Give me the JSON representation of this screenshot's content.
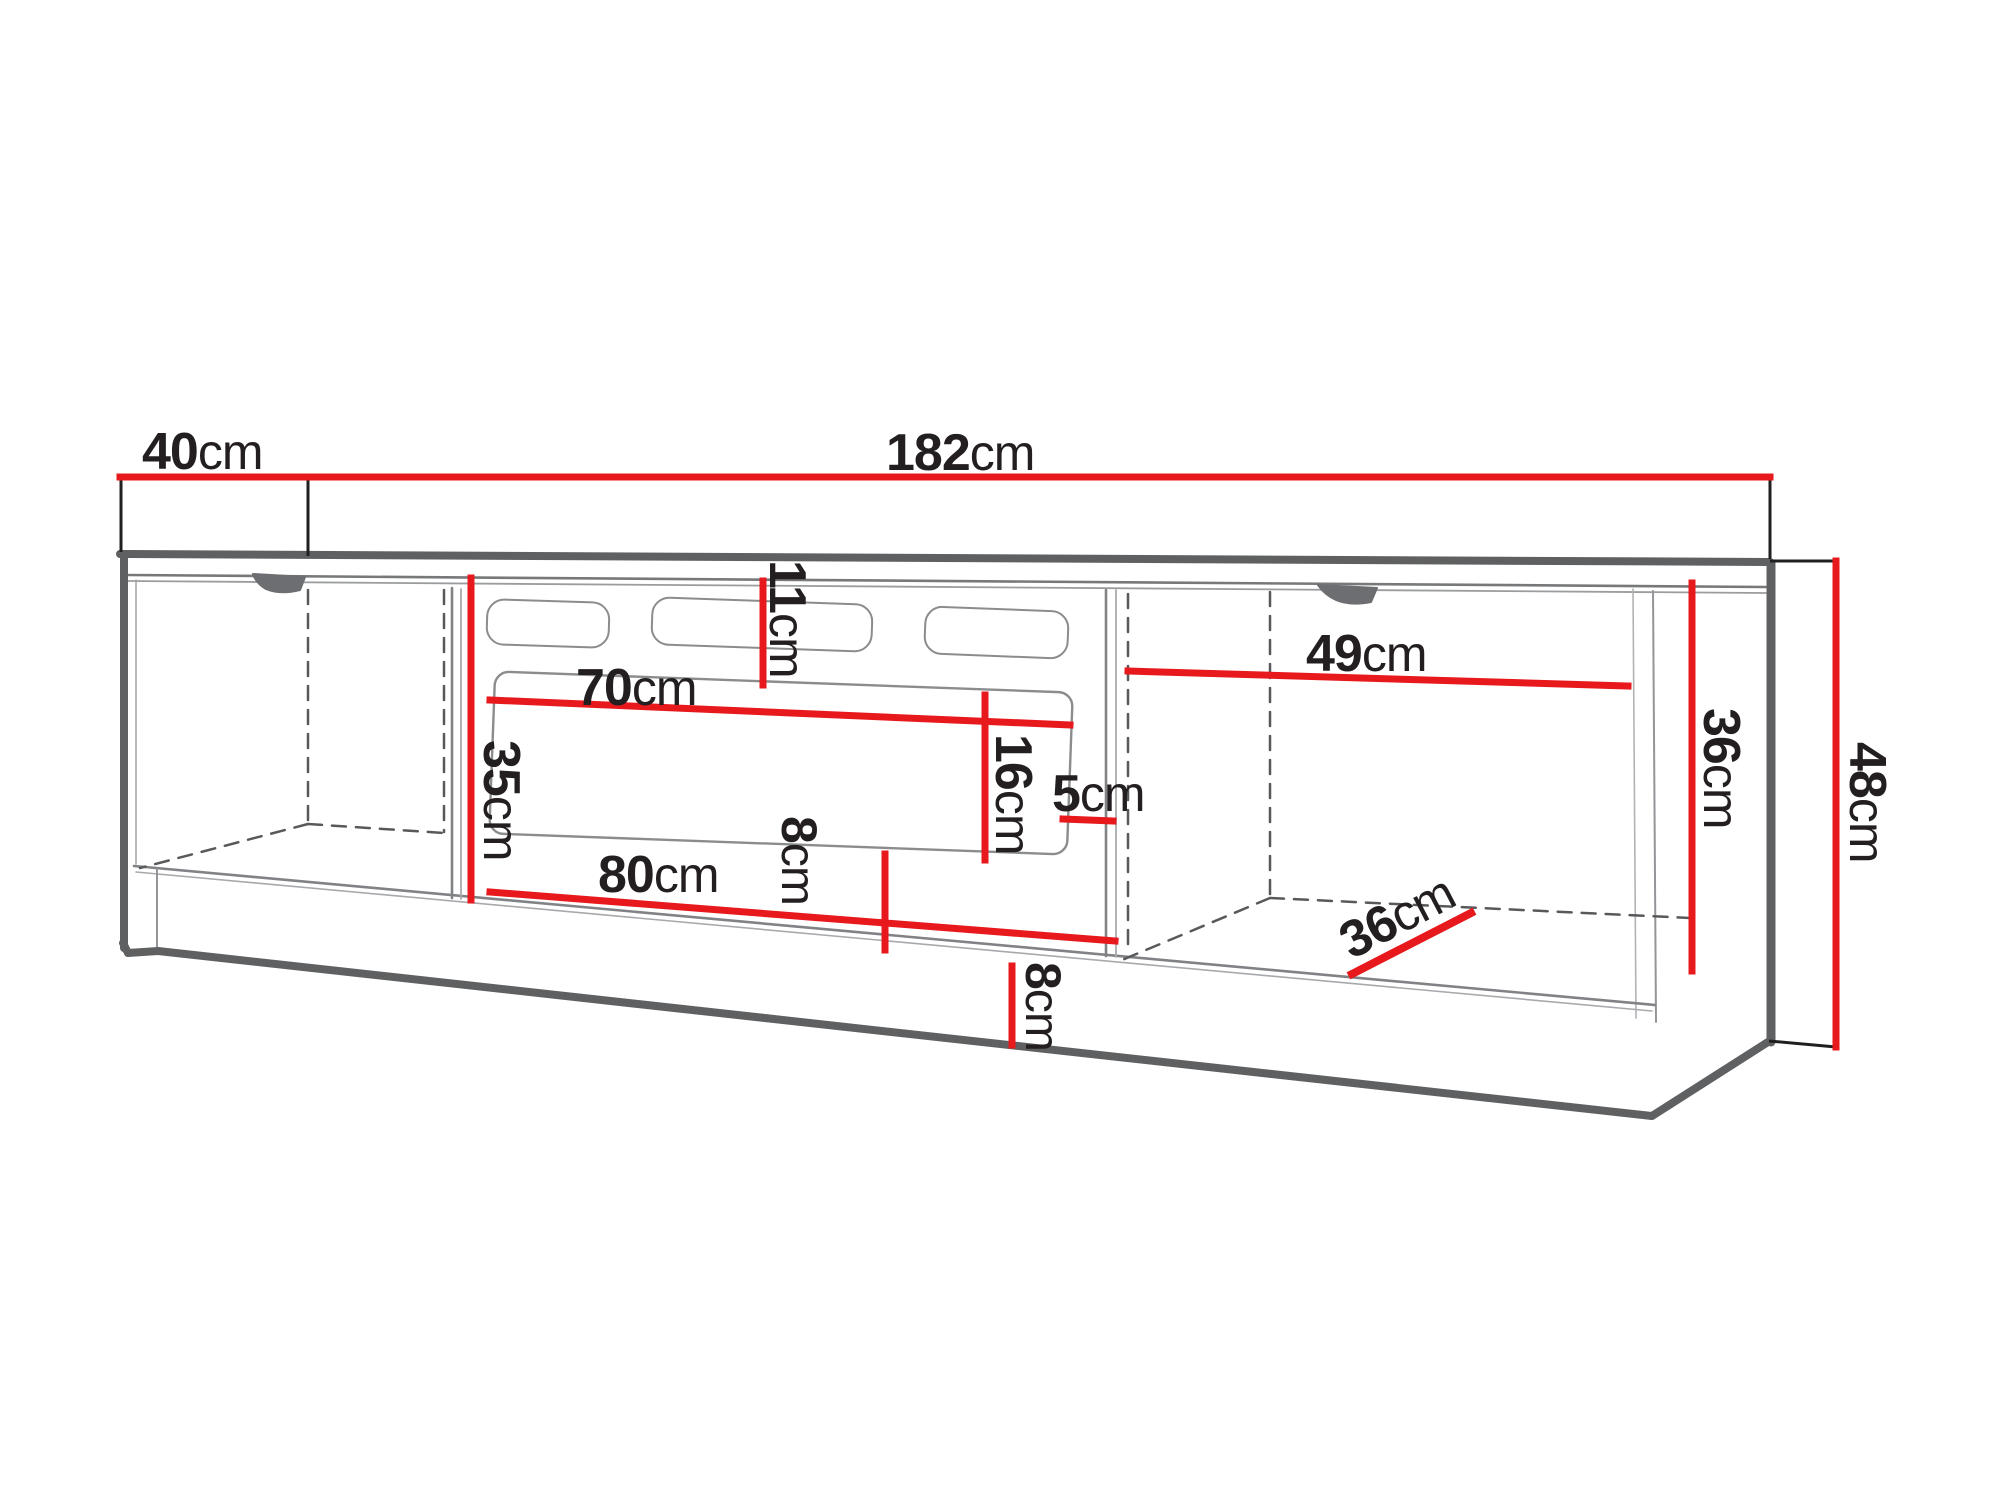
{
  "diagram": {
    "title": "TV stand technical dimension drawing",
    "unit": "cm",
    "accent_color": "#e8191d",
    "outline_color": "#5f6062",
    "dims": {
      "depth": {
        "value": "40",
        "unit": "cm"
      },
      "total_width": {
        "value": "182",
        "unit": "cm"
      },
      "right_section_width": {
        "value": "49",
        "unit": "cm"
      },
      "top_clearance": {
        "value": "11",
        "unit": "cm"
      },
      "opening_width": {
        "value": "70",
        "unit": "cm"
      },
      "middle_section_height": {
        "value": "35",
        "unit": "cm"
      },
      "opening_height": {
        "value": "16",
        "unit": "cm"
      },
      "side_gap": {
        "value": "5",
        "unit": "cm"
      },
      "opening_floor_gap": {
        "value": "8",
        "unit": "cm"
      },
      "middle_section_width": {
        "value": "80",
        "unit": "cm"
      },
      "plinth_height": {
        "value": "8",
        "unit": "cm"
      },
      "right_section_depth": {
        "value": "36",
        "unit": "cm"
      },
      "right_section_height": {
        "value": "36",
        "unit": "cm"
      },
      "total_height": {
        "value": "48",
        "unit": "cm"
      }
    }
  }
}
